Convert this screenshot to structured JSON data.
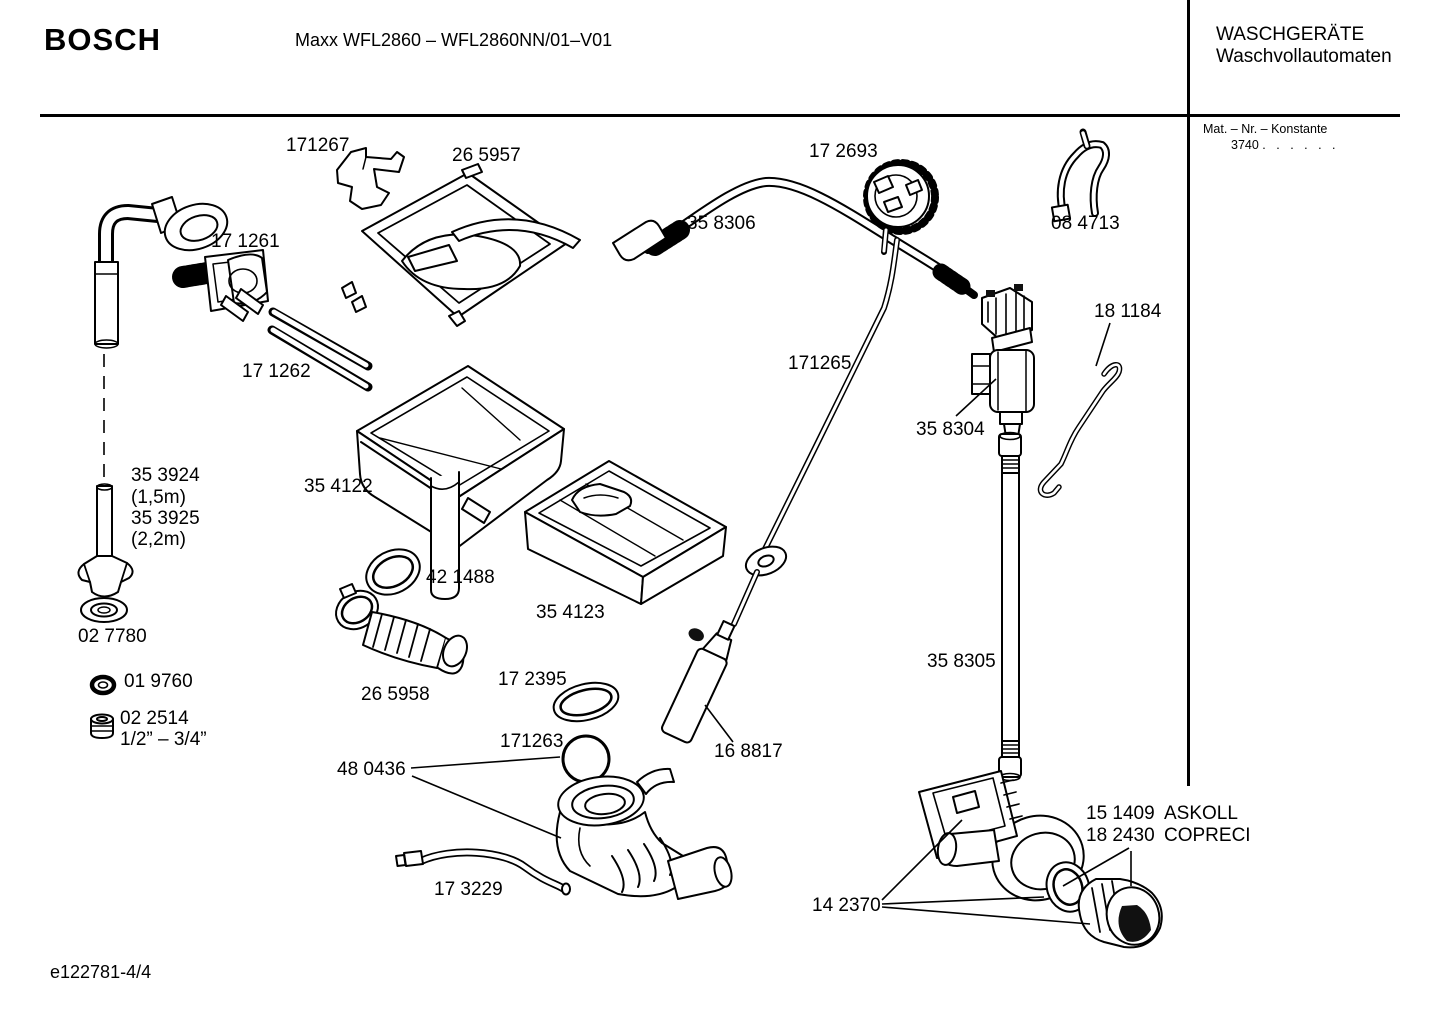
{
  "header": {
    "brand": "BOSCH",
    "model": "Maxx WFL2860 – WFL2860NN/01–V01",
    "category_line1": "WASCHGERÄTE",
    "category_line2": "Waschvollautomaten",
    "mat_label": "Mat. – Nr. – Konstante",
    "mat_value": "3740",
    "mat_dots": ". .  . . . ."
  },
  "labels": {
    "p171267": "171267",
    "p265957": "26 5957",
    "p172693": "17 2693",
    "p358306": "35 8306",
    "p084713": "08 4713",
    "p171261": "17 1261",
    "p171262": "17 1262",
    "p181184": "18 1184",
    "p171265": "171265",
    "p358304": "35 8304",
    "p353924": "35 3924",
    "p353924_len": "(1,5m)",
    "p353925": "35 3925",
    "p353925_len": "(2,2m)",
    "p354122": "35 4122",
    "p421488": "42 1488",
    "p354123": "35 4123",
    "p027780": "02 7780",
    "p019760": "01 9760",
    "p265958": "26 5958",
    "p022514": "02 2514",
    "p022514_size": "1/2” – 3/4”",
    "p172395": "17 2395",
    "p171263": "171263",
    "p480436": "48 0436",
    "p168817": "16 8817",
    "p358305": "35 8305",
    "p173229": "17 3229",
    "p151409": "15 1409",
    "p151409_mfr": "ASKOLL",
    "p182430": "18 2430",
    "p182430_mfr": "COPRECI",
    "p142370": "14 2370"
  },
  "footer": {
    "doc_number": "e122781-4/4"
  }
}
